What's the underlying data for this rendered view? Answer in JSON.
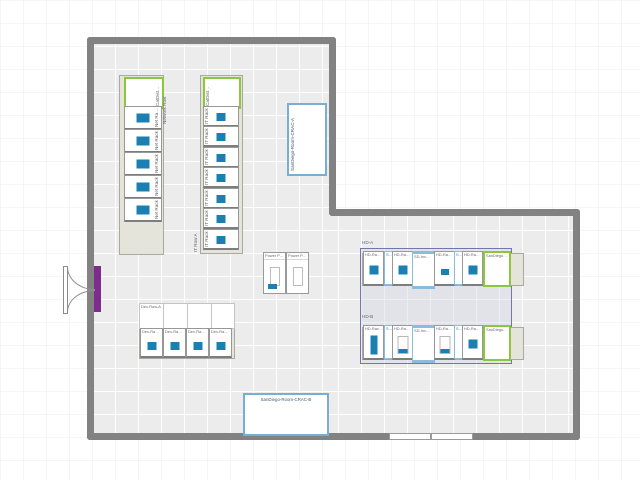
{
  "colors": {
    "device_blue": "#1c7fb2",
    "green_border": "#8cc63f",
    "light_blue_border": "#8bbcdc",
    "wall_gray": "#828282",
    "door_purple": "#7d2c8e",
    "zone_purple": "#7474ae"
  },
  "network_row": {
    "row_label": "Network Row",
    "catdist_label": "CatDist…",
    "racks": [
      {
        "label": "Net Ra…"
      },
      {
        "label": "Net Rack 2"
      },
      {
        "label": "Net Rack 3"
      },
      {
        "label": "Net Rack 4"
      },
      {
        "label": "Net Rack 5"
      }
    ]
  },
  "it_row": {
    "row_label": "IT Row A",
    "catdist_label": "CatDist…",
    "racks": [
      {
        "label": "IT Rack 1"
      },
      {
        "label": "IT Rack 2"
      },
      {
        "label": "IT Rack 3"
      },
      {
        "label": "IT Rack 4"
      },
      {
        "label": "IT Rack 5"
      },
      {
        "label": "IT Rack 6"
      },
      {
        "label": "IT Rack 7"
      }
    ]
  },
  "dev_row": {
    "row_label": "Dev-Row-A",
    "racks": [
      {
        "label": "Dev-Ra…"
      },
      {
        "label": "Dev-Ra…"
      },
      {
        "label": "Dev-Ra…"
      },
      {
        "label": "Dev-Ra…"
      }
    ]
  },
  "power_panels": [
    {
      "label": "Power P…"
    },
    {
      "label": "Power P…"
    }
  ],
  "crac_a": {
    "label": "SanDiego-Room-CRAC-A"
  },
  "crac_b": {
    "label": "SanDiego-Room-CRAC-B"
  },
  "hd_row_a": {
    "row_label": "HD-A",
    "units": [
      {
        "label": "HD-Ra…",
        "device": "sq"
      },
      {
        "label": "S…",
        "device": "none"
      },
      {
        "label": "HD-Ra…",
        "device": "sq"
      },
      {
        "label": "SD-Inv…",
        "device": "none"
      },
      {
        "label": "HD-Ra…",
        "device": "sq-low"
      },
      {
        "label": "S…",
        "device": "none"
      },
      {
        "label": "HD-Ra…",
        "device": "sq"
      },
      {
        "label": "SanDiego…",
        "device": "none"
      }
    ]
  },
  "hd_row_b": {
    "row_label": "HD-B",
    "units": [
      {
        "label": "HD-Rac…",
        "device": "bar"
      },
      {
        "label": "S…",
        "device": "none"
      },
      {
        "label": "HD-Ra…",
        "device": "slot"
      },
      {
        "label": "SD-Inv…",
        "device": "none"
      },
      {
        "label": "HD-Ra…",
        "device": "slot"
      },
      {
        "label": "S…",
        "device": "none"
      },
      {
        "label": "HD-Ra…",
        "device": "sq"
      },
      {
        "label": "SanDiego…",
        "device": "none"
      }
    ]
  }
}
